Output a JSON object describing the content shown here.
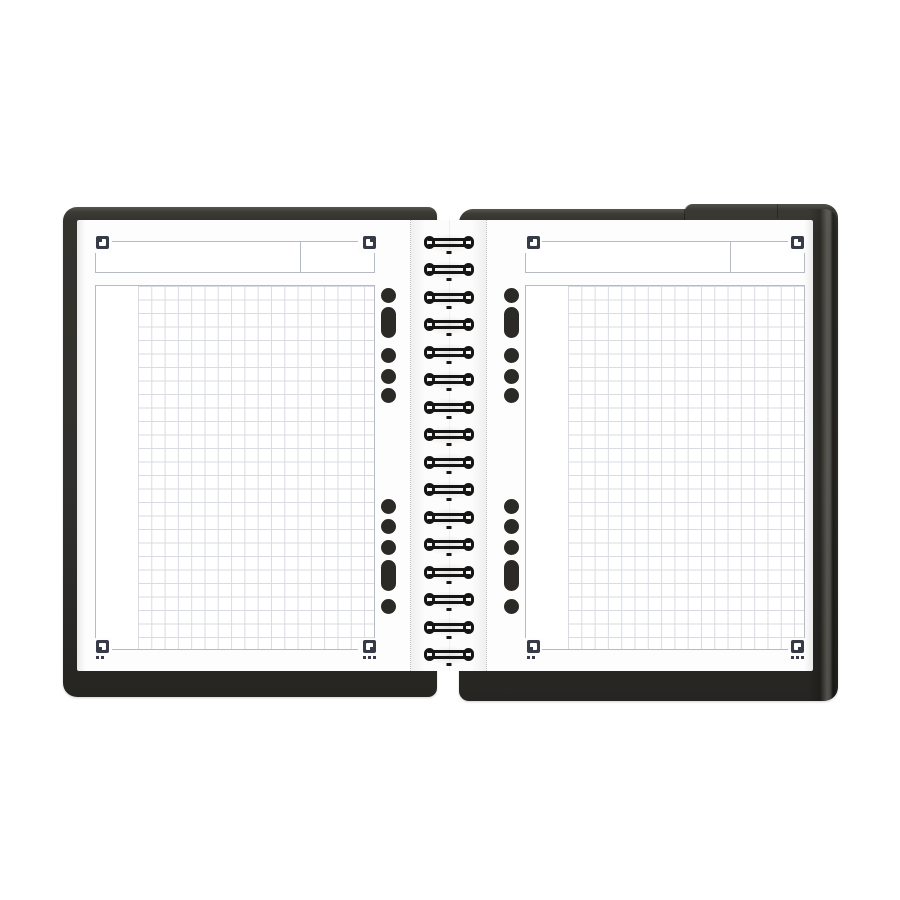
{
  "scene": {
    "type": "product-photo",
    "subject": "Open twin-wire organizer notebook with squared (graph) pages",
    "background_color": "#ffffff",
    "visible_text": ""
  },
  "colors": {
    "cover": "#32312d",
    "cover_rim": "#57564f",
    "cover_shadow": "#262522",
    "paper": "#fdfdfd",
    "header_fill": "#ffffff",
    "outline": "#b6bac2",
    "grid_line": "#d8dbe1",
    "corner_mark": "#363b47",
    "punch_hole": "#2b2a27",
    "ring_wire": "#161513",
    "perforation_dot": "#bcbcbc"
  },
  "binding": {
    "style": "twin-wire-rings",
    "ring_count": 16
  },
  "page_template": {
    "header": {
      "cells": 2,
      "divider_ratio": 0.735
    },
    "grid": {
      "pattern": "squared",
      "cell_px": 13.3,
      "blank_left_margin": true
    },
    "corner_marks": [
      {
        "position": "top-left",
        "dots": 0
      },
      {
        "position": "top-right",
        "dots": 0
      },
      {
        "position": "bottom-left",
        "dots": 2
      },
      {
        "position": "bottom-right",
        "dots": 3
      }
    ],
    "punch_holes": {
      "top_group": [
        "circle",
        "capsule",
        "circle",
        "circle",
        "circle"
      ],
      "bottom_group": [
        "circle",
        "circle",
        "circle",
        "capsule",
        "circle"
      ]
    }
  },
  "pages": [
    {
      "side": "left"
    },
    {
      "side": "right"
    }
  ]
}
